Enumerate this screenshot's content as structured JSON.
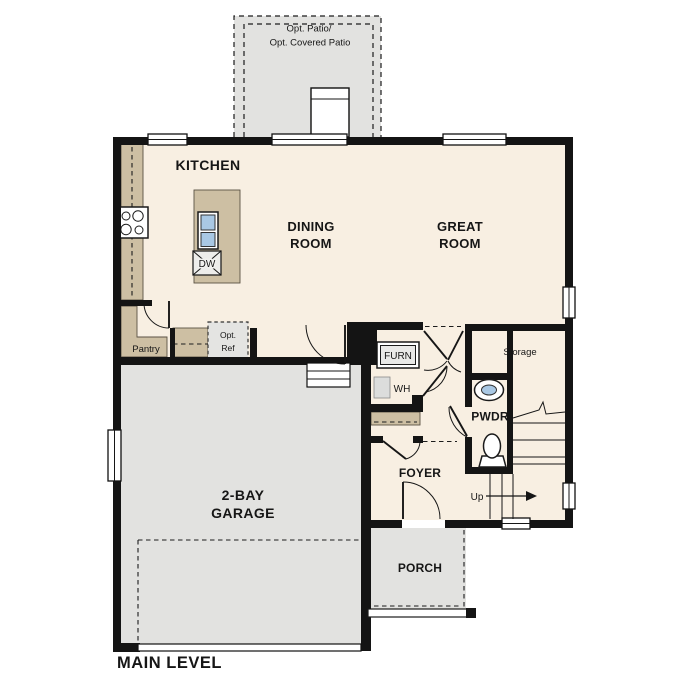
{
  "plan": {
    "title": "MAIN LEVEL",
    "labels": {
      "kitchen": "KITCHEN",
      "dining_1": "DINING",
      "dining_2": "ROOM",
      "great_1": "GREAT",
      "great_2": "ROOM",
      "garage_1": "2-BAY",
      "garage_2": "GARAGE",
      "foyer": "FOYER",
      "porch": "PORCH",
      "pwdr": "PWDR",
      "storage": "Storage",
      "pantry": "Pantry",
      "patio_1": "Opt. Patio/",
      "patio_2": "Opt. Covered Patio",
      "furnace": "FURN",
      "water_heater": "WH",
      "dishwasher": "DW",
      "opt_ref_1": "Opt.",
      "opt_ref_2": "Ref",
      "stairs_up": "Up"
    },
    "colors": {
      "wall": "#141414",
      "floor": "#f8efe2",
      "concrete": "#e2e2e0",
      "counter": "#cdbfa3",
      "sink": "#a9c8e4"
    }
  }
}
